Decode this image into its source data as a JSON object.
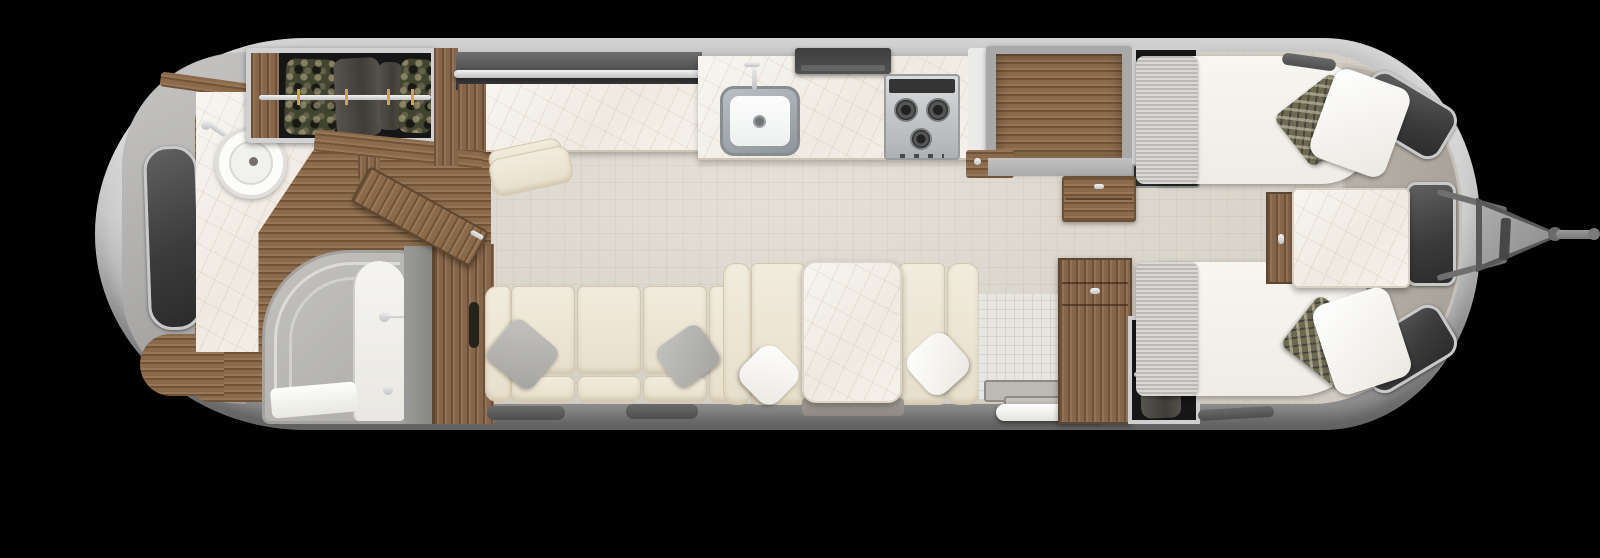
{
  "scene": {
    "type": "travel-trailer-floor-plan-top-view",
    "background_color": "#000000",
    "shell_color": "#c2c2c2",
    "floor_tile_color": "#dcd6cb",
    "bath_floor_wood_color": "#8a6a4a",
    "cabinet_wood_color": "#86664a",
    "countertop_marble_color": "#f6f3ee",
    "upholstery_cream_color": "#eee7d6",
    "bedding_white_color": "#f6f4ef",
    "blanket_grey_color": "#c9c7c3",
    "accent_pillow_color": "#6d6a52",
    "window_glass_color": "#3c3c3c",
    "stainless_color": "#c3c7c9"
  },
  "areas": {
    "bathroom_rear": {
      "items": [
        "side-window",
        "vanity-marble-counter",
        "round-vessel-sink",
        "faucet",
        "shower-enclosure",
        "bath-wood-floor",
        "pocket-door-wall",
        "entry-door-open"
      ]
    },
    "wardrobe_rear": {
      "items": [
        "hanging-rod",
        "hanging-clothes"
      ]
    },
    "desk_credenza": {
      "items": [
        "marble-desk-top",
        "chrome-rail",
        "rear-shelf",
        "desk-chair"
      ]
    },
    "galley": {
      "items": [
        "marble-counter",
        "stainless-sink",
        "kitchen-faucet",
        "range-hood",
        "three-burner-cooktop",
        "refrigerator-cabinet",
        "wood-ledge"
      ]
    },
    "lounge": {
      "items": [
        "three-seat-sofa",
        "two-grey-throw-pillows",
        "dinette-bench-left",
        "dinette-bench-right",
        "marble-dinette-table",
        "two-white-throw-pillows"
      ]
    },
    "entry": {
      "items": [
        "tiled-wall",
        "step-plates",
        "white-step-bar"
      ]
    },
    "bedroom_front": {
      "items": [
        "twin-bed-top",
        "twin-bed-bottom",
        "grey-foot-blankets",
        "white-pillows",
        "patterned-accent-pillows",
        "marble-nightstand",
        "wood-nightstand-side",
        "dresser-top",
        "dresser-wardrobe-bottom",
        "hanging-closet-top",
        "hanging-closet-bottom",
        "curved-front-console",
        "front-windows"
      ]
    },
    "exterior": {
      "items": [
        "aluminum-shell",
        "a-frame-hitch",
        "tongue-jack",
        "coupler-bar"
      ]
    }
  }
}
